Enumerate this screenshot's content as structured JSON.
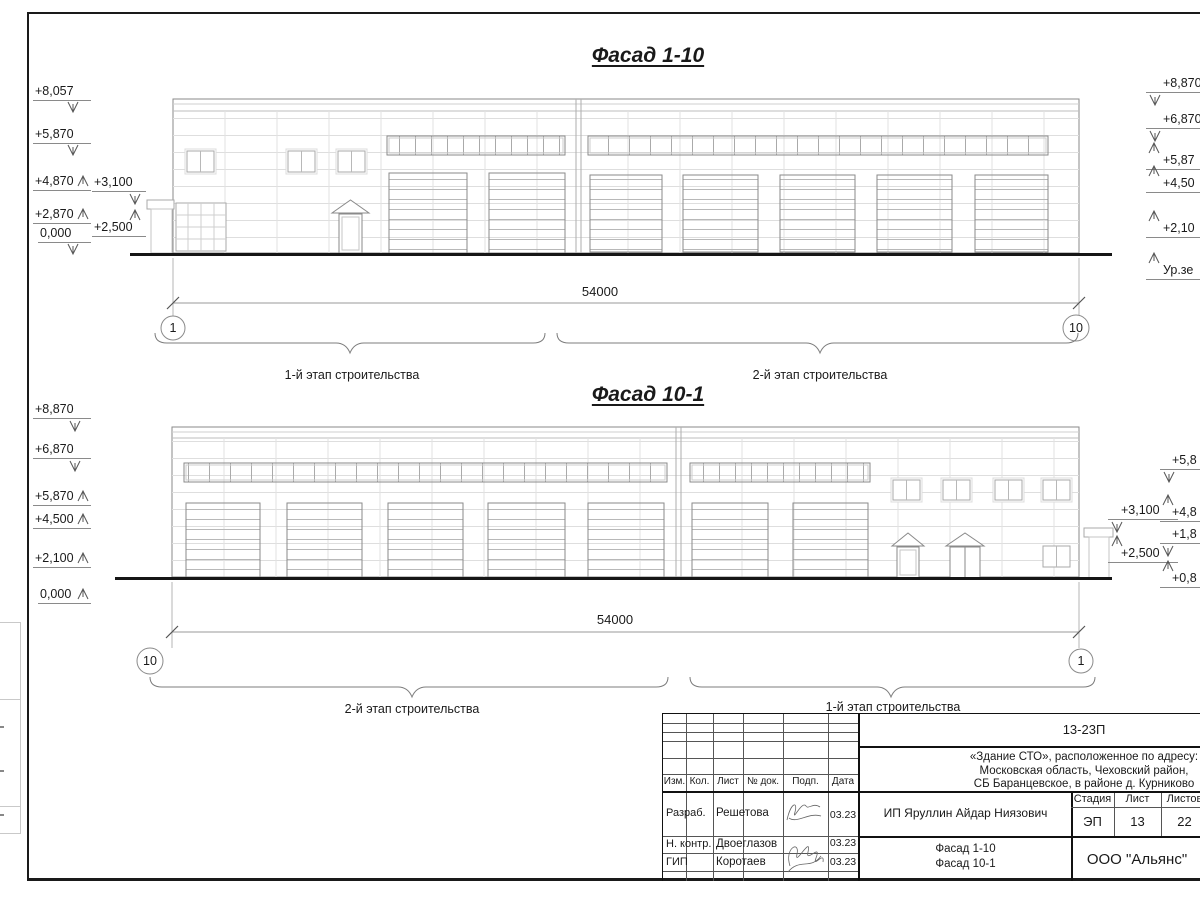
{
  "facade_top": {
    "title": "Фасад 1-10",
    "left_marks": [
      "+8,057",
      "+5,870",
      "+4,870",
      "+3,100",
      "+2,870",
      "+2,500",
      "0,000"
    ],
    "right_marks": [
      "+8,870",
      "+6,870",
      "+5,87",
      "+4,50",
      "+2,10",
      "Ур.зе"
    ],
    "dimension": "54000",
    "axis_start": "1",
    "axis_end": "10",
    "stage1_label": "1-й этап строительства",
    "stage2_label": "2-й этап строительства"
  },
  "facade_bottom": {
    "title": "Фасад 10-1",
    "left_marks": [
      "+8,870",
      "+6,870",
      "+5,870",
      "+4,500",
      "+2,100",
      "0,000"
    ],
    "right_marks": [
      "+5,8",
      "+3,100",
      "+4,8",
      "+1,8",
      "+2,500",
      "+0,8"
    ],
    "dimension": "54000",
    "axis_start": "10",
    "axis_end": "1",
    "stage1_label": "1-й этап строительства",
    "stage2_label": "2-й этап строительства"
  },
  "title_block": {
    "doc_number": "13-23П",
    "address_line1": "«Здание СТО», расположенное по адресу:",
    "address_line2": "Московская область, Чеховский район,",
    "address_line3": "СБ Баранцевское, в районе д. Курниково",
    "columns": [
      "Изм.",
      "Кол.",
      "Лист",
      "№ док.",
      "Подп.",
      "Дата"
    ],
    "rows": [
      {
        "role": "Разраб.",
        "name": "Решетова",
        "date": "03.23"
      },
      {
        "role": "Н. контр.",
        "name": "Двоеглазов",
        "date": "03.23"
      },
      {
        "role": "ГИП",
        "name": "Коротаев",
        "date": "03.23"
      }
    ],
    "client": "ИП Яруллин Айдар Ниязович",
    "stage_label": "Стадия",
    "sheet_label": "Лист",
    "sheets_label": "Листов",
    "stage": "ЭП",
    "sheet": "13",
    "sheets": "22",
    "sheet_title_line1": "Фасад 1-10",
    "sheet_title_line2": "Фасад 10-1",
    "company": "ООО \"Альянс\""
  }
}
